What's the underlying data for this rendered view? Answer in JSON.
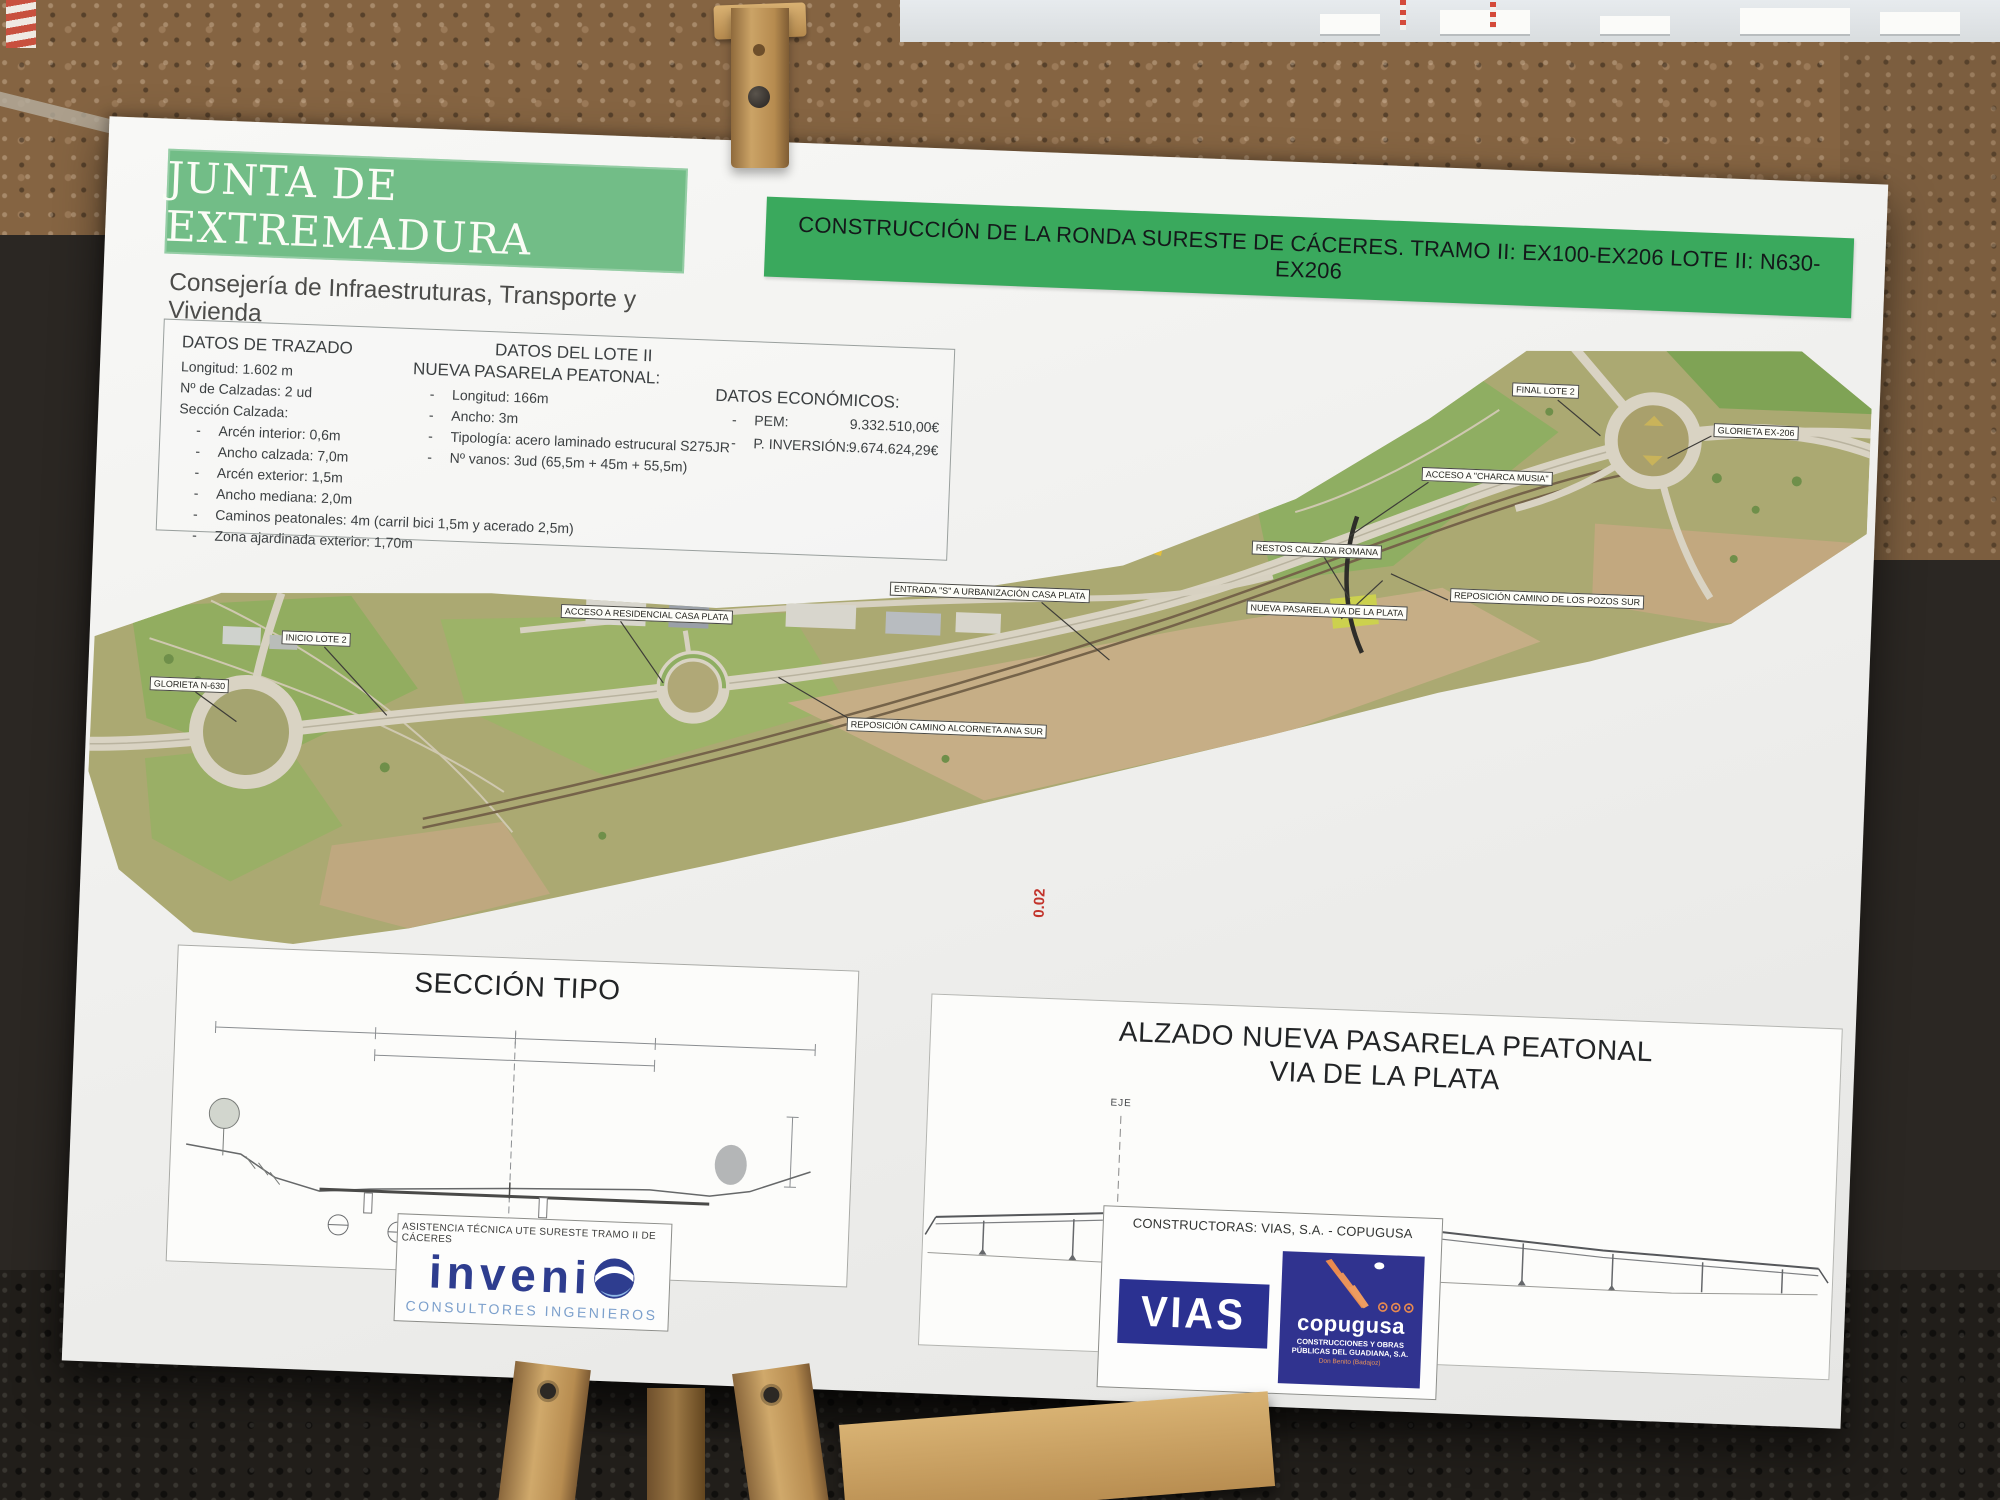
{
  "ui": {
    "dash": "-"
  },
  "header": {
    "junta_title": "JUNTA DE EXTREMADURA",
    "junta_subtitle": "Consejería de Infraestruturas, Transporte y Vivienda",
    "banner_text": "CONSTRUCCIÓN DE LA RONDA SURESTE DE CÁCERES. TRAMO II: EX100-EX206 LOTE II: N630-EX206"
  },
  "datos_trazado": {
    "title": "DATOS DE TRAZADO",
    "lines": [
      "Longitud: 1.602 m",
      "Nº de Calzadas: 2 ud",
      "Sección Calzada:"
    ],
    "items": [
      "Arcén interior: 0,6m",
      "Ancho calzada: 7,0m",
      "Arcén exterior: 1,5m",
      "Ancho mediana: 2,0m",
      "Caminos peatonales: 4m (carril bici 1,5m y acerado 2,5m)",
      "Zona ajardinada exterior: 1,70m"
    ]
  },
  "datos_lote": {
    "title": "DATOS DEL LOTE II",
    "subtitle": "NUEVA PASARELA PEATONAL:",
    "items": [
      "Longitud: 166m",
      "Ancho: 3m",
      "Tipología: acero laminado estrucural S275JR",
      "Nº vanos: 3ud (65,5m + 45m + 55,5m)"
    ]
  },
  "datos_economicos": {
    "title": "DATOS ECONÓMICOS:",
    "items": [
      {
        "label": "PEM:",
        "value": "9.332.510,00€"
      },
      {
        "label": "P. INVERSIÓN:",
        "value": "9.674.624,29€"
      }
    ]
  },
  "map_labels": [
    "GLORIETA N-630",
    "INICIO LOTE 2",
    "ACCESO A RESIDENCIAL CASA PLATA",
    "ENTRADA \"S\" A URBANIZACIÓN CASA PLATA",
    "REPOSICIÓN CAMINO ALCORNETA ANA SUR",
    "RESTOS CALZADA ROMANA",
    "NUEVA PASARELA VIA DE LA PLATA",
    "ACCESO A \"CHARCA MUSIA\"",
    "REPOSICIÓN CAMINO DE LOS POZOS SUR",
    "FINAL LOTE 2",
    "GLORIETA EX-206"
  ],
  "seccion": {
    "title": "SECCIÓN TIPO"
  },
  "alzado": {
    "title_line1": "ALZADO NUEVA PASARELA PEATONAL",
    "title_line2": "VIA DE LA PLATA",
    "eje_label": "EJE",
    "slope_label": "0.02"
  },
  "footer": {
    "asistencia": "ASISTENCIA TÉCNICA UTE SURESTE TRAMO II DE CÁCERES",
    "invenio_letters": "inveni",
    "invenio_tagline": "CONSULTORES INGENIEROS",
    "constructoras_title": "CONSTRUCTORAS: VIAS, S.A. - COPUGUSA",
    "vias_label": "VIAS",
    "copugusa_label": "copugusa",
    "copugusa_sub1": "CONSTRUCCIONES Y OBRAS",
    "copugusa_sub2": "PÚBLICAS DEL GUADIANA, S.A.",
    "copugusa_city": "Don Benito (Badajoz)"
  },
  "colors": {
    "junta_green": "#72bd87",
    "banner_green": "#3aa95d",
    "vias_blue": "#2b3191",
    "copugusa_blue": "#30338f",
    "copugusa_orange": "#e98a4f",
    "invenio_navy": "#2e3d8f",
    "invenio_lightblue": "#8fb8e6",
    "consultores_blue": "#7ca0cc"
  }
}
